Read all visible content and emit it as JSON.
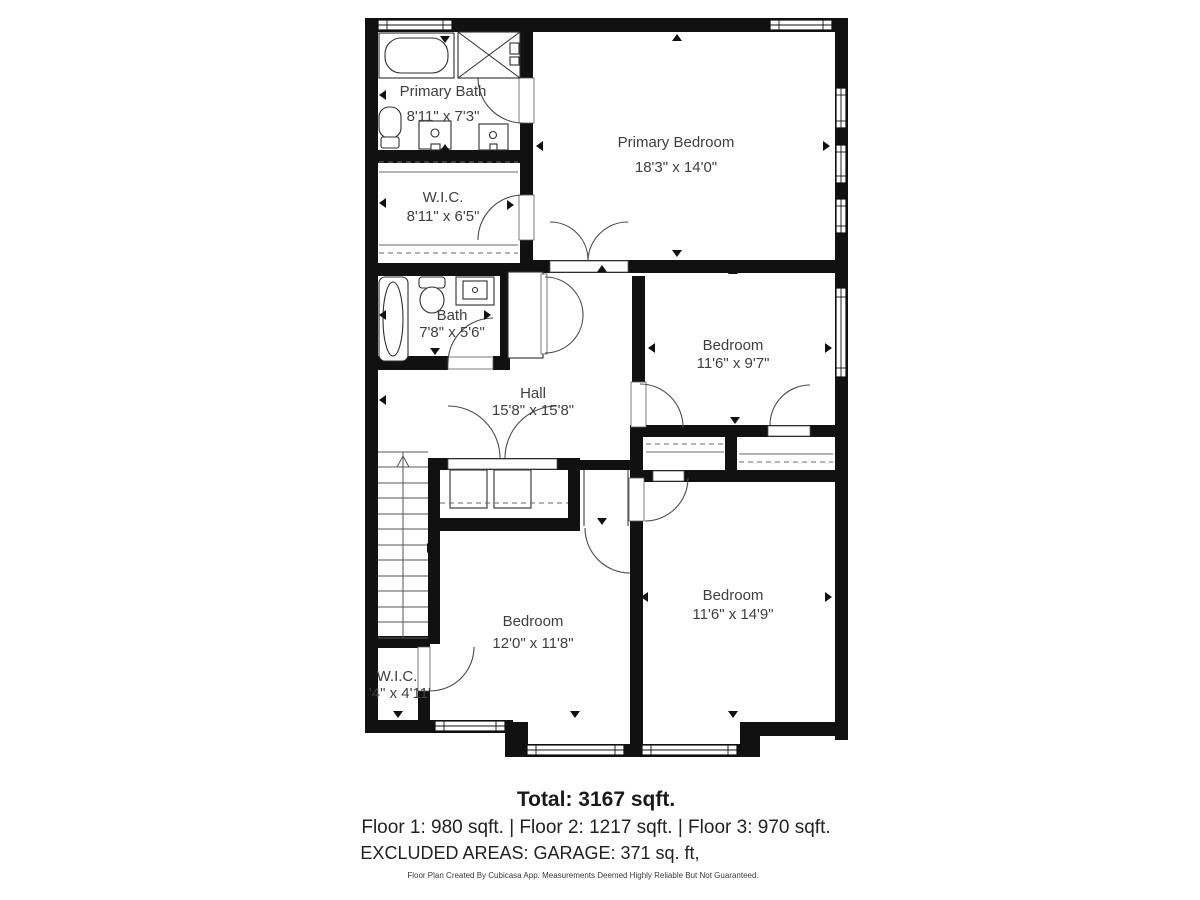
{
  "page": {
    "background": "#ffffff"
  },
  "floorplan": {
    "rooms": [
      {
        "name": "Primary Bath",
        "dims": "8'11\" x 7'3\""
      },
      {
        "name": "W.I.C.",
        "dims": "8'11\" x 6'5\""
      },
      {
        "name": "Primary Bedroom",
        "dims": "18'3\" x 14'0\""
      },
      {
        "name": "Bath",
        "dims": "7'8\" x 5'6\""
      },
      {
        "name": "Hall",
        "dims": "15'8\" x 15'8\""
      },
      {
        "name": "Bedroom",
        "dims": "11'6\" x 9'7\""
      },
      {
        "name": "Bedroom",
        "dims": "12'0\" x 11'8\""
      },
      {
        "name": "Bedroom",
        "dims": "11'6\" x 14'9\""
      },
      {
        "name": "W.I.C.",
        "dims": "3'4\" x 4'11\""
      }
    ],
    "fixtures": [
      "bathtub",
      "shower",
      "toilet",
      "sink",
      "washer-dryer",
      "stairs"
    ],
    "colors": {
      "wall": "#111111",
      "floor": "#ffffff",
      "label": "#3f3f3f"
    }
  },
  "footer": {
    "total": "Total: 3167 sqft.",
    "floors": "Floor 1: 980 sqft. | Floor 2: 1217 sqft. | Floor 3: 970 sqft.",
    "excluded": "EXCLUDED AREAS: GARAGE: 371 sq. ft,",
    "disclaimer": "Floor Plan Created By Cubicasa App. Measurements Deemed Highly Reliable But Not Guaranteed."
  }
}
